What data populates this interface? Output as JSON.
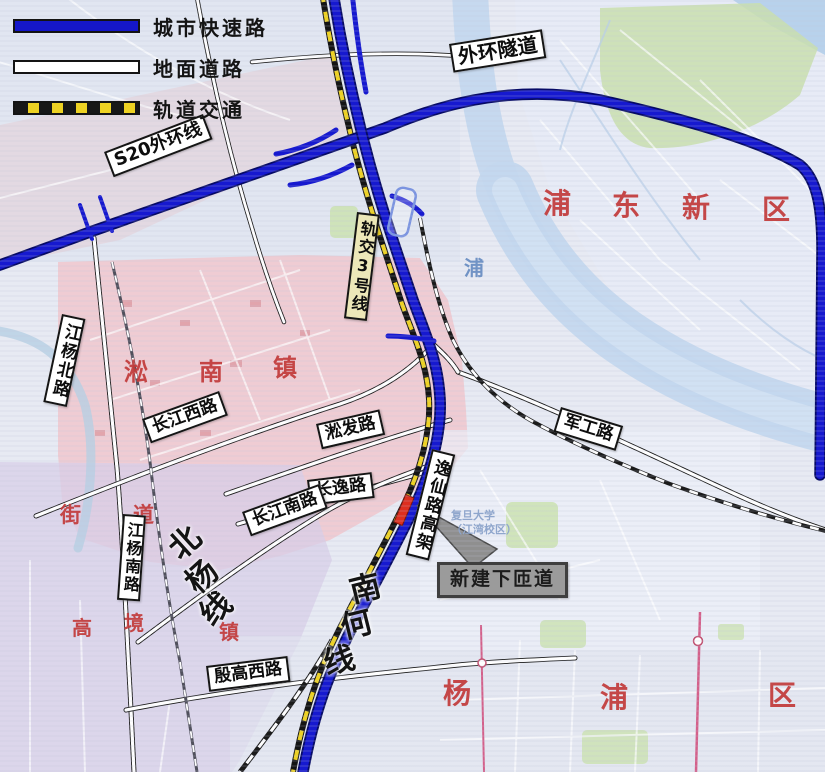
{
  "legend": {
    "items": [
      {
        "label": "城市快速路",
        "type": "expressway"
      },
      {
        "label": "地面道路",
        "type": "surface-road"
      },
      {
        "label": "轨道交通",
        "type": "rail-transit"
      }
    ]
  },
  "labels": {
    "waihuan_tunnel": "外环隧道",
    "s20": "S20外环线",
    "rail3": "轨交3号线",
    "jiangyang_north": "江杨北路",
    "changjiang_west": "长江西路",
    "songfa": "淞发路",
    "changyi": "长逸路",
    "changjiang_south": "长江南路",
    "jungong": "军工路",
    "yixian_viaduct": "逸仙路高架",
    "new_ramp": "新建下匝道",
    "jiangyang_south": "江杨南路",
    "yingao_west": "殷高西路"
  },
  "areas": {
    "pudong": "浦东新区",
    "songnan": "淞南镇",
    "yangpu": "杨浦区",
    "gaojing": "高境镇",
    "jiedao": "街道",
    "beiyang": "北杨线",
    "nanhe": "南何线",
    "fudan_line1": "复旦大学",
    "fudan_line2": "（江湾校区）",
    "river_char": "浦"
  },
  "colors": {
    "expressway": "#1619cf",
    "surface_road": "#ffffff",
    "rail_transit_yellow": "#eed223",
    "district_red": "#c23a3a",
    "ramp_marker_red": "#dd2f1f",
    "callout_gray": "#9b9b9b"
  }
}
